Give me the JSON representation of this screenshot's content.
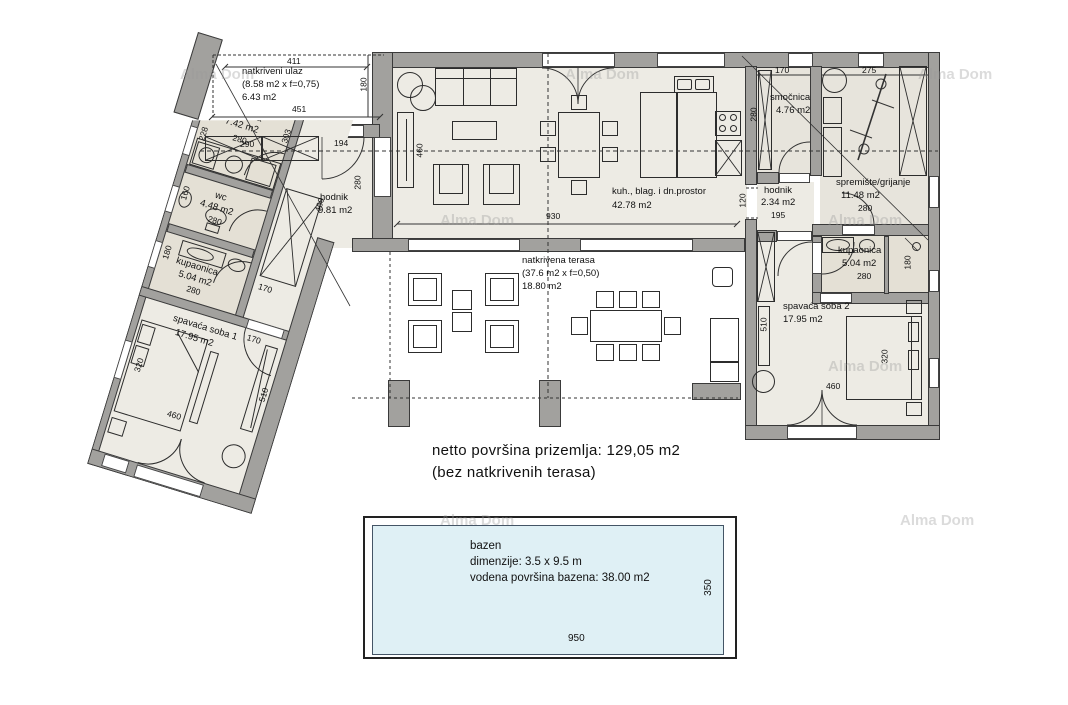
{
  "watermark": "Alma Dom",
  "summary": {
    "line1": "netto površina prizemlja: 129,05 m2",
    "line2": "(bez natkrivenih terasa)"
  },
  "rooms": {
    "entry": {
      "name": "natkriveni ulaz",
      "calc": "(8.58 m2 x f=0,75)",
      "area": "6.43 m2"
    },
    "praonica": {
      "name": "praonica",
      "area": "7.42 m2"
    },
    "wc": {
      "name": "wc",
      "area": "4.48 m2"
    },
    "kupaonica1": {
      "name": "kupaonica",
      "area": "5.04 m2"
    },
    "spavaca1": {
      "name": "spavaća soba 1",
      "area": "17.95 m2"
    },
    "hodnik1": {
      "name": "hodnik",
      "area": "9.81 m2"
    },
    "living": {
      "name": "kuh., blag. i dn.prostor",
      "area": "42.78 m2"
    },
    "terasa": {
      "name": "natkrivena terasa",
      "calc": "(37.6 m2 x f=0,50)",
      "area": "18.80 m2"
    },
    "smocnica": {
      "name": "smočnica",
      "area": "4.76 m2"
    },
    "hodnik2": {
      "name": "hodnik",
      "area": "2.34 m2"
    },
    "spremiste": {
      "name": "spremište/grijanje",
      "area": "11.48 m2"
    },
    "kupaonica2": {
      "name": "kupaonica",
      "area": "5.04 m2"
    },
    "spavaca2": {
      "name": "spavaća soba 2",
      "area": "17.95 m2"
    }
  },
  "pool": {
    "name": "bazen",
    "dim_label": "dimenzije: 3.5 x 9.5 m",
    "area_label": "vodena površina bazena: 38.00 m2",
    "width_dim": "950",
    "height_dim": "350"
  },
  "dims": {
    "entry_top": "411",
    "entry_bottom": "451",
    "entry_side": "180",
    "entry_door": "194",
    "closet": "290",
    "living_width": "930",
    "living_depth": "460",
    "living_left": "280",
    "praonica_left": "228",
    "praonica_right": "303",
    "praonica_w": "280",
    "corridor_len": "460",
    "corridor_w": "170",
    "wc_left": "160",
    "wc_w": "280",
    "kup1_left": "180",
    "kup1_w": "280",
    "sp1_left": "320",
    "sp1_right": "510",
    "sp1_bottom": "460",
    "sp1_door": "170",
    "smocnica_top": "170",
    "smocnica_left": "280",
    "spremiste_top": "275",
    "spremiste_w": "280",
    "hodnik2_w": "195",
    "hodnik2_left": "120",
    "kup2_w": "280",
    "kup2_right": "180",
    "sp2_left": "510",
    "sp2_bed": "320",
    "sp2_bottom": "460"
  },
  "colors": {
    "wall": "#a2a19e",
    "floor": "#edebe4",
    "bath_floor": "#e4e0d5",
    "water": "#dff0f5"
  }
}
